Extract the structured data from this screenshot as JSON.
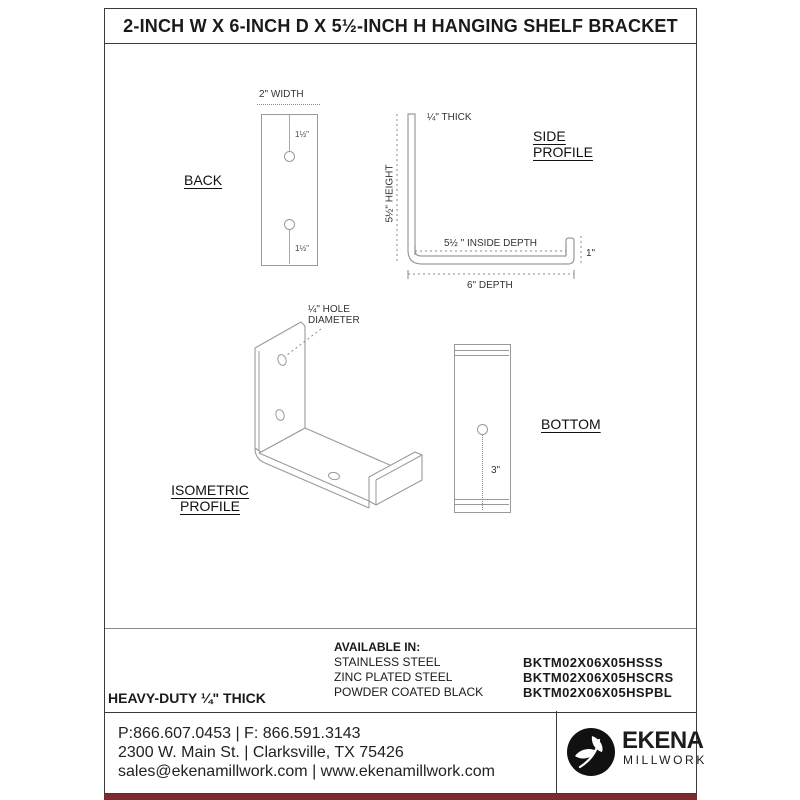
{
  "title": "2-INCH W X 6-INCH D X 5½-INCH H HANGING SHELF BRACKET",
  "views": {
    "back": {
      "label": "BACK",
      "width_dim": "2\" WIDTH",
      "hole_top_dim": "1½\"",
      "hole_bottom_dim": "1½\""
    },
    "side": {
      "label_line1": "SIDE",
      "label_line2": "PROFILE",
      "thick_dim": "¼\" THICK",
      "height_dim": "5½\" HEIGHT",
      "inside_depth_dim": "5½ \" INSIDE DEPTH",
      "lip_dim": "1\"",
      "depth_dim": "6\" DEPTH"
    },
    "isometric": {
      "label_line1": "ISOMETRIC",
      "label_line2": "PROFILE",
      "hole_dim_line1": "¼\" HOLE",
      "hole_dim_line2": "DIAMETER"
    },
    "bottom": {
      "label": "BOTTOM",
      "hole_dim": "3\""
    }
  },
  "specs": {
    "heavy_duty": "HEAVY-DUTY ¼\" THICK",
    "available_in_label": "AVAILABLE IN:",
    "finishes": [
      {
        "name": "STAINLESS STEEL",
        "sku": "BKTM02X06X05HSSS"
      },
      {
        "name": "ZINC PLATED STEEL",
        "sku": "BKTM02X06X05HSCRS"
      },
      {
        "name": "POWDER COATED BLACK",
        "sku": "BKTM02X06X05HSPBL"
      }
    ]
  },
  "footer": {
    "lines": [
      "P:866.607.0453  |  F: 866.591.3143",
      "2300 W. Main St.  |  Clarksville, TX 75426",
      "sales@ekenamillwork.com  |  www.ekenamillwork.com"
    ],
    "brand_name": "EKENA",
    "brand_sub": "MILLWORK"
  },
  "colors": {
    "accent_bar": "#7c2b2e",
    "drawing_line": "#9a9a9a",
    "text": "#1a1a1a"
  }
}
